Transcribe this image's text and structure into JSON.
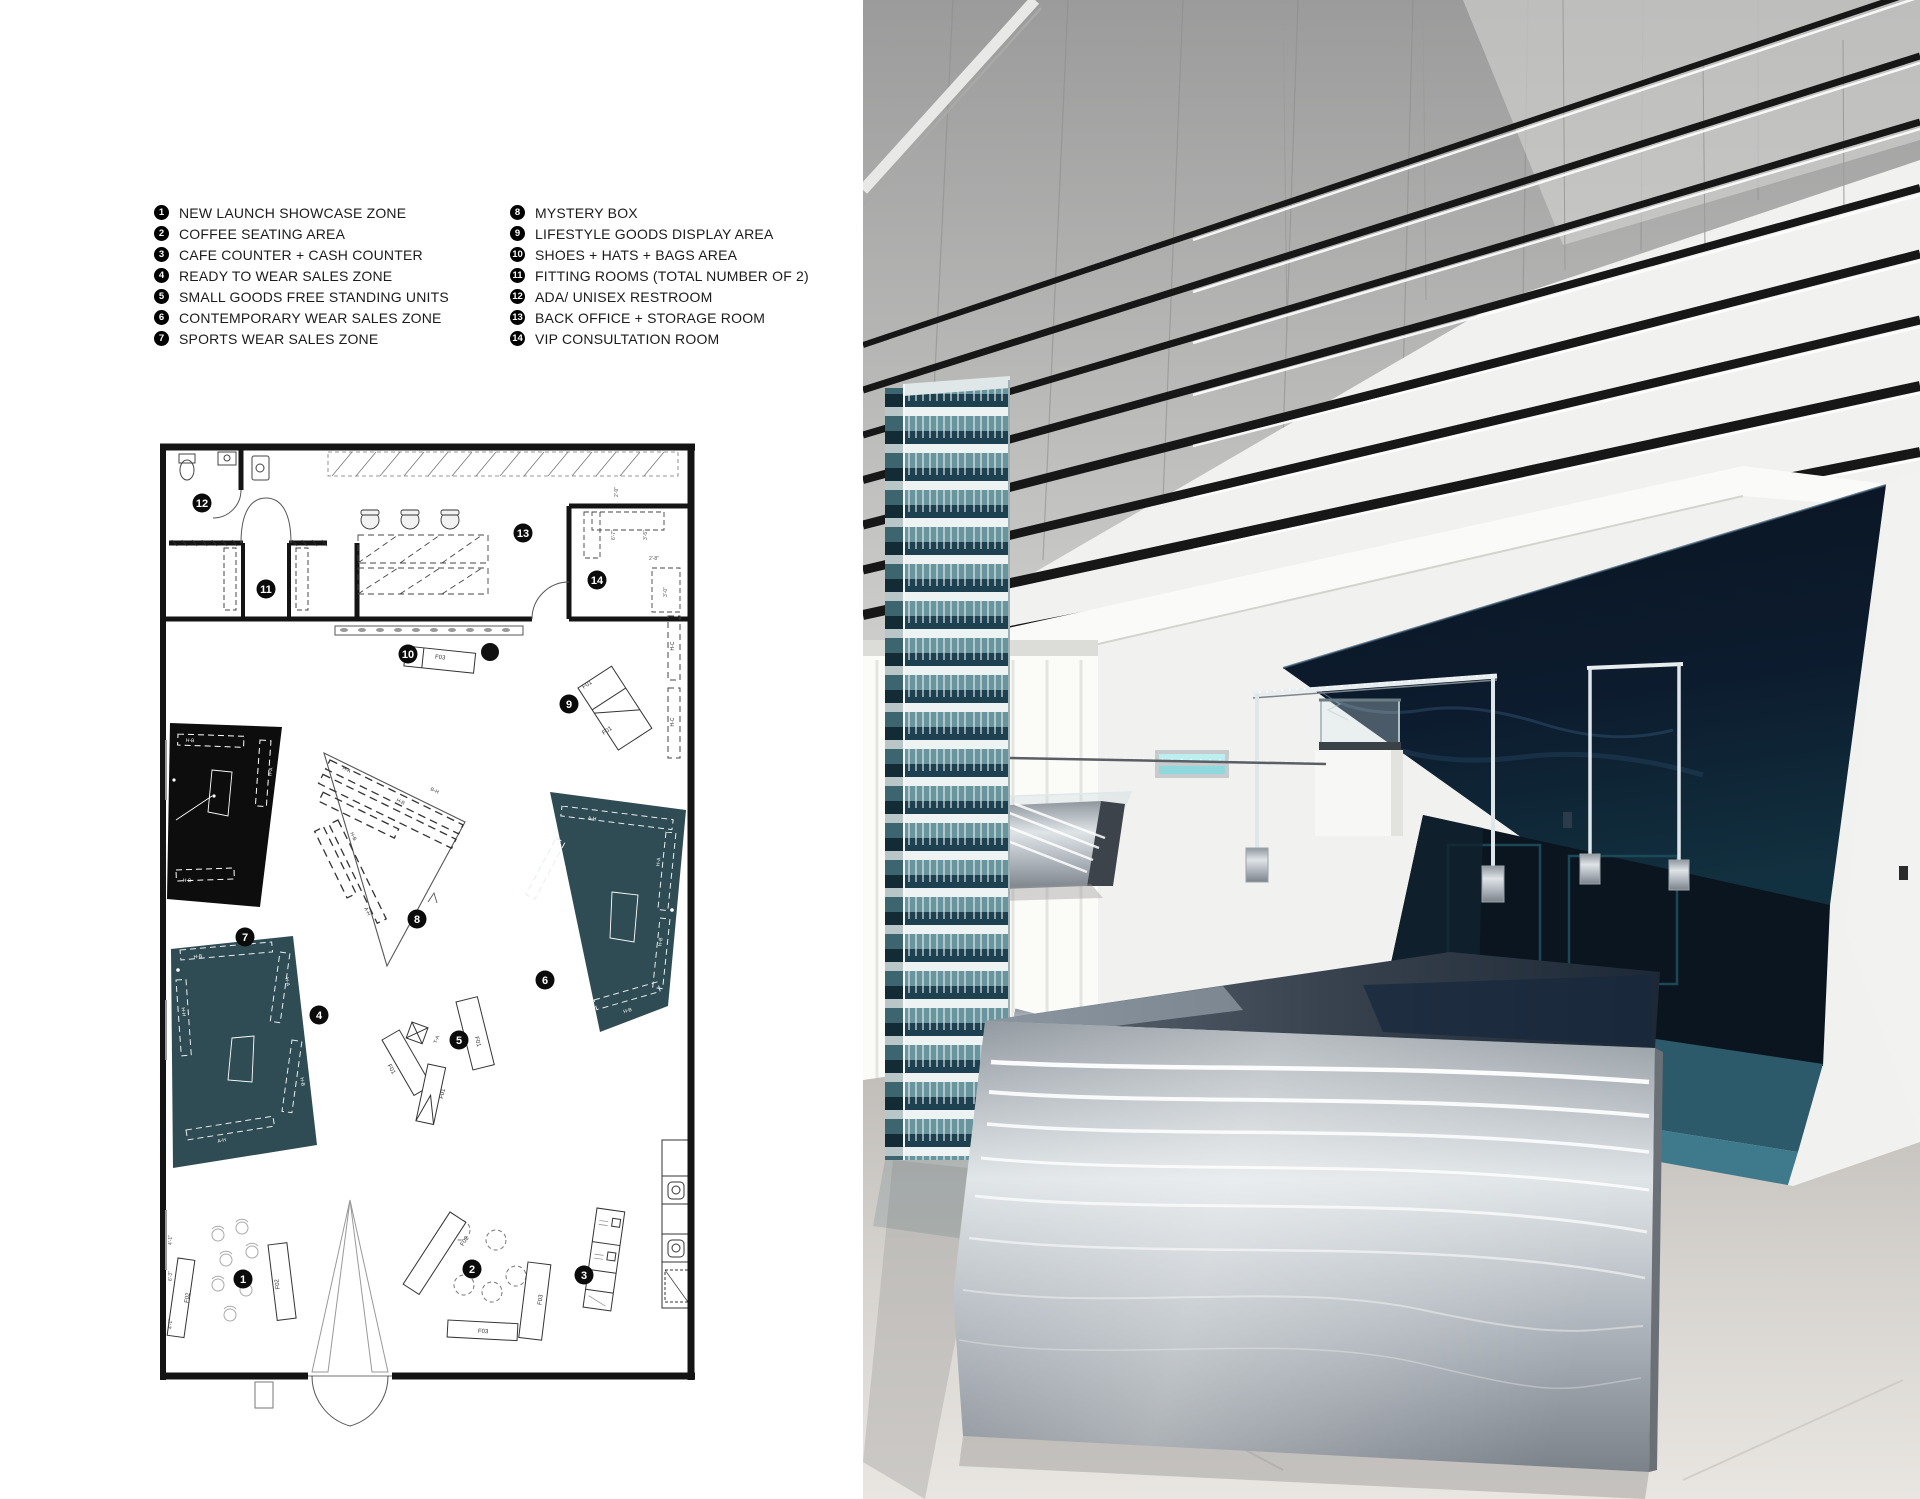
{
  "board": {
    "background": "#ffffff"
  },
  "legend": {
    "items": [
      {
        "num": "1",
        "label": "NEW LAUNCH SHOWCASE ZONE"
      },
      {
        "num": "2",
        "label": "COFFEE SEATING AREA"
      },
      {
        "num": "3",
        "label": "CAFE COUNTER  +  CASH COUNTER"
      },
      {
        "num": "4",
        "label": "READY TO WEAR SALES ZONE"
      },
      {
        "num": "5",
        "label": "SMALL GOODS FREE STANDING UNITS"
      },
      {
        "num": "6",
        "label": "CONTEMPORARY WEAR SALES ZONE"
      },
      {
        "num": "7",
        "label": "SPORTS WEAR SALES ZONE"
      },
      {
        "num": "8",
        "label": "MYSTERY BOX"
      },
      {
        "num": "9",
        "label": "LIFESTYLE GOODS DISPLAY AREA"
      },
      {
        "num": "10",
        "label": "SHOES +  HATS + BAGS AREA"
      },
      {
        "num": "11",
        "label": "FITTING ROOMS (TOTAL NUMBER OF 2)"
      },
      {
        "num": "12",
        "label": "ADA/ UNISEX RESTROOM"
      },
      {
        "num": "13",
        "label": "BACK OFFICE + STORAGE ROOM"
      },
      {
        "num": "14",
        "label": "VIP CONSULTATION ROOM"
      }
    ]
  },
  "plan": {
    "colors": {
      "wall": "#141414",
      "zone_teal": "#2f4c55",
      "zone_black": "#0d0d0d"
    },
    "markers": [
      {
        "n": "1",
        "x": 83,
        "y": 839
      },
      {
        "n": "2",
        "x": 312,
        "y": 829
      },
      {
        "n": "3",
        "x": 424,
        "y": 835
      },
      {
        "n": "4",
        "x": 159,
        "y": 575
      },
      {
        "n": "5",
        "x": 299,
        "y": 600
      },
      {
        "n": "6",
        "x": 385,
        "y": 540
      },
      {
        "n": "7",
        "x": 85,
        "y": 497
      },
      {
        "n": "8",
        "x": 257,
        "y": 479
      },
      {
        "n": "9",
        "x": 409,
        "y": 264
      },
      {
        "n": "10",
        "x": 248,
        "y": 214
      },
      {
        "n": "11",
        "x": 106,
        "y": 149
      },
      {
        "n": "12",
        "x": 42,
        "y": 63
      },
      {
        "n": "13",
        "x": 363,
        "y": 93
      },
      {
        "n": "14",
        "x": 437,
        "y": 140
      }
    ],
    "labels": [
      {
        "t": "2'-9\"",
        "x": 458,
        "y": 52,
        "r": -90,
        "c": "#555",
        "s": 5
      },
      {
        "t": "6'-7\"",
        "x": 455,
        "y": 95,
        "r": -90,
        "c": "#555",
        "s": 5
      },
      {
        "t": "3'-5\"",
        "x": 487,
        "y": 95,
        "r": -90,
        "c": "#555",
        "s": 5
      },
      {
        "t": "2'-8\"",
        "x": 494,
        "y": 120,
        "r": 0,
        "c": "#555",
        "s": 5
      },
      {
        "t": "3'-0\"",
        "x": 507,
        "y": 152,
        "r": -90,
        "c": "#555",
        "s": 5
      },
      {
        "t": "4'-1\"",
        "x": 12,
        "y": 800,
        "r": -90,
        "c": "#555",
        "s": 5
      },
      {
        "t": "6'-3\"",
        "x": 12,
        "y": 836,
        "r": -90,
        "c": "#555",
        "s": 5
      },
      {
        "t": "4'-1\"",
        "x": 12,
        "y": 884,
        "r": -90,
        "c": "#555",
        "s": 5
      },
      {
        "t": "H-C",
        "x": 514,
        "y": 206,
        "r": -90,
        "c": "#333",
        "s": 5
      },
      {
        "t": "H-C",
        "x": 514,
        "y": 282,
        "r": -90,
        "c": "#333",
        "s": 5
      },
      {
        "t": "F03",
        "x": 280,
        "y": 219,
        "r": 6,
        "c": "#333",
        "s": 6
      },
      {
        "t": "F01",
        "x": 428,
        "y": 246,
        "r": -33,
        "c": "#333",
        "s": 6
      },
      {
        "t": "F01",
        "x": 448,
        "y": 292,
        "r": -33,
        "c": "#333",
        "s": 6
      },
      {
        "t": "H-B",
        "x": 30,
        "y": 302,
        "r": 3,
        "c": "#fff",
        "s": 5
      },
      {
        "t": "H-A",
        "x": 112,
        "y": 332,
        "r": -82,
        "c": "#fff",
        "s": 5
      },
      {
        "t": "H-B",
        "x": 27,
        "y": 442,
        "r": 3,
        "c": "#fff",
        "s": 5
      },
      {
        "t": "H-A",
        "x": 186,
        "y": 331,
        "r": 26,
        "c": "#333",
        "s": 5
      },
      {
        "t": "H-B",
        "x": 240,
        "y": 363,
        "r": 26,
        "c": "#333",
        "s": 5
      },
      {
        "t": "B-H",
        "x": 274,
        "y": 352,
        "r": 26,
        "c": "#333",
        "s": 5
      },
      {
        "t": "H-B",
        "x": 192,
        "y": 397,
        "r": 64,
        "c": "#333",
        "s": 5
      },
      {
        "t": "A-H",
        "x": 206,
        "y": 472,
        "r": 64,
        "c": "#333",
        "s": 5
      },
      {
        "t": "A-H",
        "x": 432,
        "y": 380,
        "r": 6,
        "c": "#fff",
        "s": 5
      },
      {
        "t": "H-A",
        "x": 500,
        "y": 422,
        "r": -84,
        "c": "#fff",
        "s": 5
      },
      {
        "t": "H-B",
        "x": 502,
        "y": 502,
        "r": -84,
        "c": "#fff",
        "s": 5
      },
      {
        "t": "H-B",
        "x": 468,
        "y": 572,
        "r": -16,
        "c": "#fff",
        "s": 5
      },
      {
        "t": "B-H",
        "x": 404,
        "y": 430,
        "r": -62,
        "c": "#fff",
        "s": 5
      },
      {
        "t": "H-B",
        "x": 38,
        "y": 518,
        "r": -6,
        "c": "#fff",
        "s": 5
      },
      {
        "t": "H-A",
        "x": 126,
        "y": 542,
        "r": 80,
        "c": "#fff",
        "s": 5
      },
      {
        "t": "H-H",
        "x": 22,
        "y": 572,
        "r": 84,
        "c": "#fff",
        "s": 5
      },
      {
        "t": "H-B",
        "x": 141,
        "y": 642,
        "r": 80,
        "c": "#fff",
        "s": 5
      },
      {
        "t": "A-H",
        "x": 62,
        "y": 702,
        "r": -10,
        "c": "#fff",
        "s": 5
      },
      {
        "t": "T-A",
        "x": 278,
        "y": 600,
        "r": -70,
        "c": "#333",
        "s": 5
      },
      {
        "t": "F01",
        "x": 230,
        "y": 630,
        "r": 60,
        "c": "#333",
        "s": 6
      },
      {
        "t": "F01",
        "x": 284,
        "y": 654,
        "r": -78,
        "c": "#333",
        "s": 6
      },
      {
        "t": "F01",
        "x": 316,
        "y": 602,
        "r": 76,
        "c": "#333",
        "s": 6
      },
      {
        "t": "F02",
        "x": 306,
        "y": 802,
        "r": -57,
        "c": "#333",
        "s": 6
      },
      {
        "t": "F03",
        "x": 323,
        "y": 893,
        "r": 3,
        "c": "#333",
        "s": 6
      },
      {
        "t": "F03",
        "x": 382,
        "y": 860,
        "r": -83,
        "c": "#333",
        "s": 6
      },
      {
        "t": "F02",
        "x": 29,
        "y": 858,
        "r": -82,
        "c": "#333",
        "s": 6
      },
      {
        "t": "F02",
        "x": 119,
        "y": 844,
        "r": -98,
        "c": "#333",
        "s": 6
      }
    ]
  },
  "photo": {
    "colors": {
      "navy_canopy": "#0b1626",
      "carpet_teal": "#2e6478",
      "column_teal": "#1d4150",
      "steel": "#c7ccd1",
      "floor": "#d8d5d1",
      "ceiling_gray": "#a8a8a8",
      "beam_black": "#171717"
    }
  }
}
